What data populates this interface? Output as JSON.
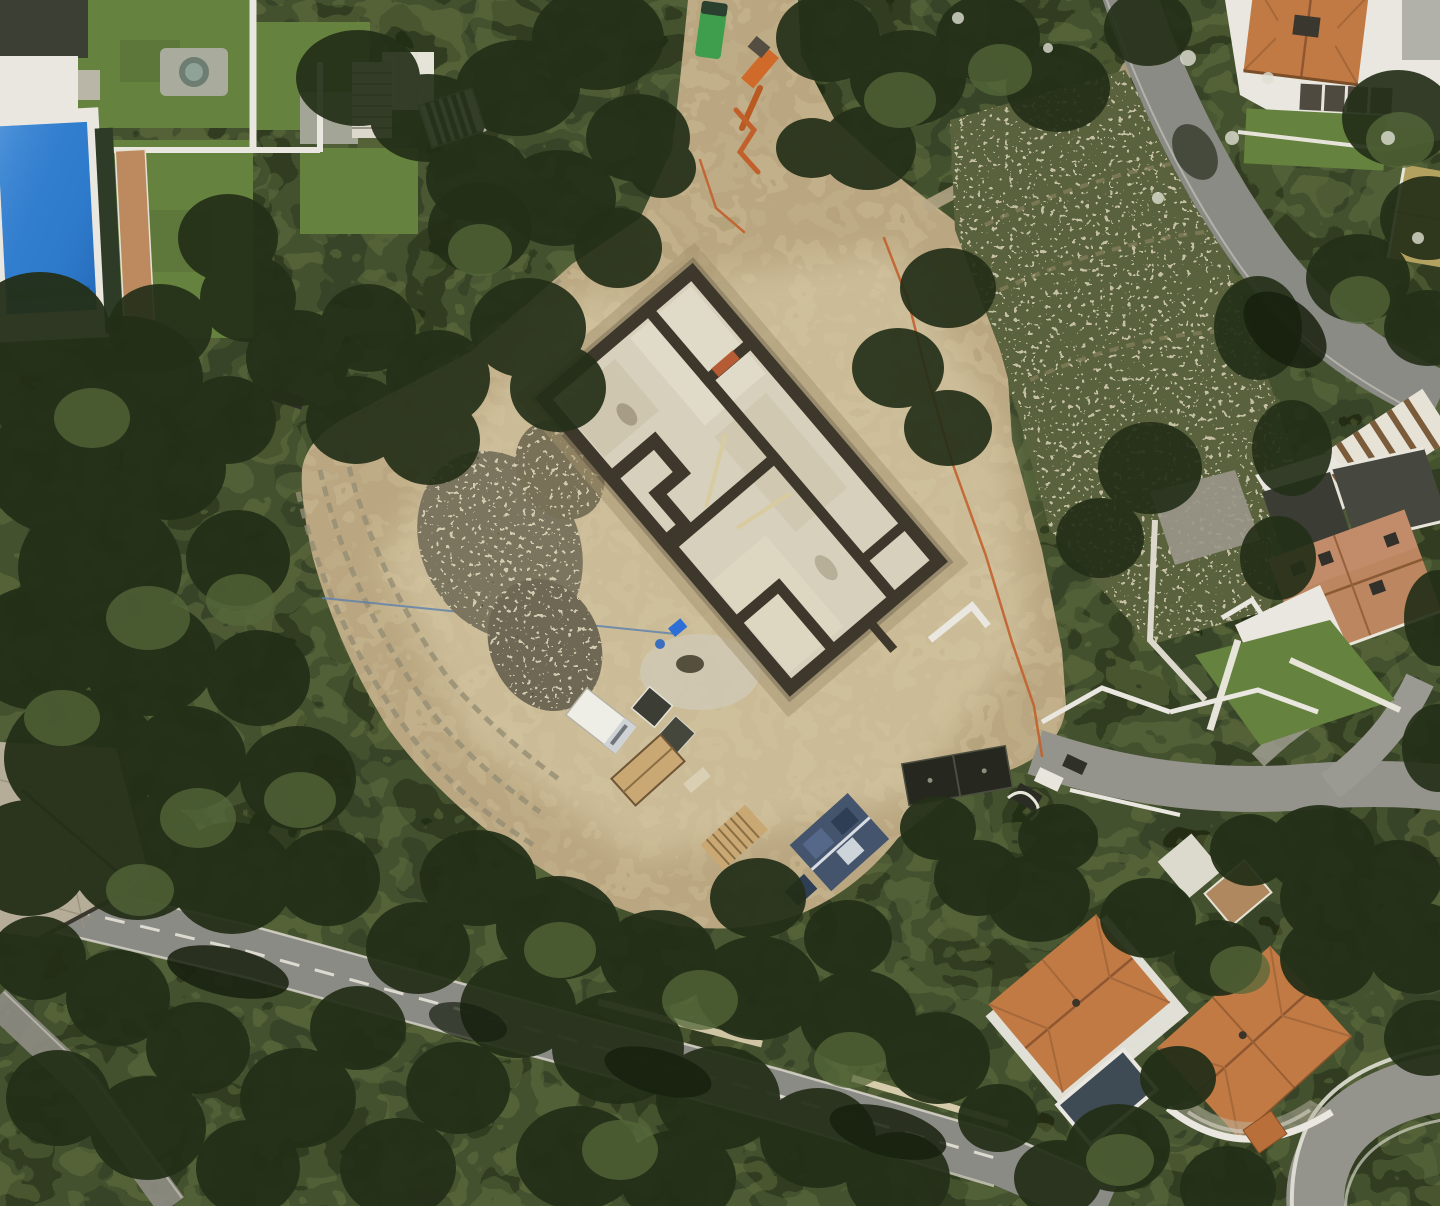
{
  "scene": {
    "title": "Aerial satellite view — hillside villa construction site among pine woodland",
    "type": "satellite-photo",
    "width_px": 1440,
    "height_px": 1206
  },
  "palette": {
    "tree_base": "#44512e",
    "tree_dark": "#242f18",
    "tree_deep": "#17200e",
    "tree_light": "#55683a",
    "lawn": "#66823f",
    "dirt": "#c2b08a",
    "dirt_light": "#ddd1ae",
    "concrete": "#d7d0bc",
    "wall_dark": "#3e382c",
    "white_wall": "#e9e7df",
    "road": "#8b8b86",
    "road_light": "#94938c",
    "pool_blue": "#2f7ccd",
    "pool_dark": "#3e4b54",
    "hedge_dark": "#2e3b26",
    "roof_orange": "#c27a45",
    "roof_brown": "#bb8660",
    "roof_tan": "#b3a15f",
    "scrub": "#59623d",
    "rubble_grey": "#7b745f",
    "paver_grey": "#b5ad97",
    "path_terracotta": "#bd8a60",
    "fence_orange": "#c2602c",
    "container_green": "#3f9e4d",
    "machine_blue": "#2e6fd6",
    "tarp_blue": "#3c4f6a",
    "wood_tan": "#c9a873",
    "truck_white": "#efeee6",
    "container_dark": "#26281f"
  },
  "features": {
    "trees": {
      "label": "Pine woodland canopy"
    },
    "excavation": {
      "label": "Graded earthworks and excavation site"
    },
    "foundation": {
      "label": "Concrete foundation walls under construction"
    },
    "rubble": {
      "label": "Rock and rubble stockpiles"
    },
    "vehicles": {
      "label": "Site vehicles, containers and materials"
    },
    "pool": {
      "label": "Swimming pool"
    },
    "bottom_road": {
      "label": "Road with lane markings"
    },
    "right_road": {
      "label": "Curving residential road"
    },
    "junction_road": {
      "label": "Driveway junction road"
    },
    "corner_road": {
      "label": "Curved corner road"
    },
    "house_top_right": {
      "label": "Villa with terracotta roof"
    },
    "house_mid_right": {
      "label": "Villa with brown tiled roof"
    },
    "house_bottom_left": {
      "label": "Villa with hip roof and plunge pool"
    },
    "house_bottom_right": {
      "label": "Villa with cross-hip roof"
    },
    "terrace": {
      "label": "Paved terrace"
    },
    "scrub": {
      "label": "Rocky scrub slope"
    },
    "fence": {
      "label": "Orange safety fencing"
    },
    "garden": {
      "label": "Landscaped garden with lawn"
    }
  }
}
